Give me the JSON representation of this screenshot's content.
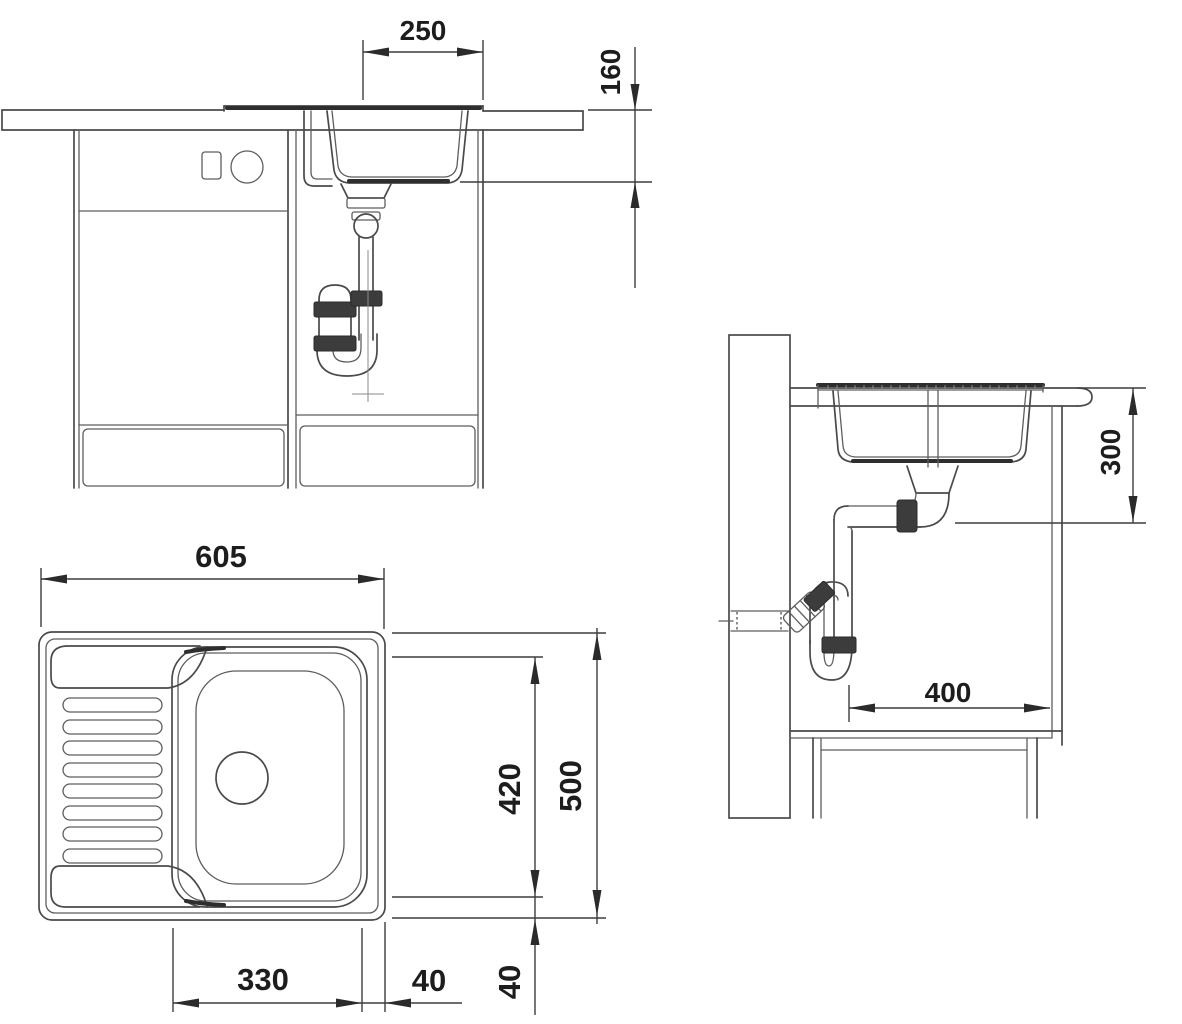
{
  "drawing": {
    "title": "kitchen sink installation technical drawing",
    "line_color": "#4a4a4a",
    "accent_color": "#2e2e2e",
    "background": "#ffffff",
    "views": {
      "front_elevation": {
        "description": "front view of sink cabinet with drain trap",
        "dims": {
          "bowl_width": "250",
          "bowl_depth": "160"
        }
      },
      "side_section": {
        "description": "side section view with wall drain connection",
        "dims": {
          "drain_height": "300",
          "wall_clearance": "400"
        }
      },
      "top_plan": {
        "description": "plan view of sink with drainboard and bowl",
        "dims": {
          "overall_width": "605",
          "bowl_length": "420",
          "overall_depth": "500",
          "bowl_width": "330",
          "rim_gap_horizontal": "40",
          "rim_gap_vertical": "40"
        }
      }
    }
  }
}
